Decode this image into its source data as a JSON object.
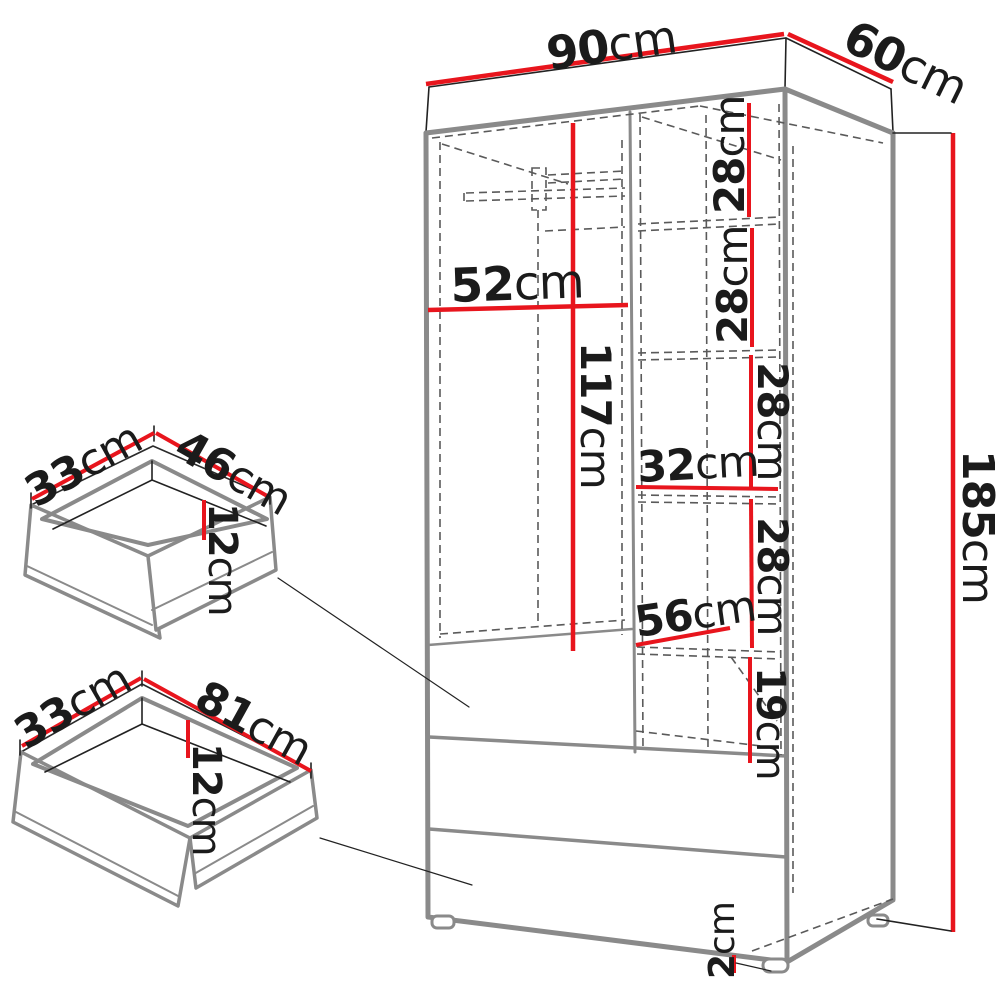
{
  "title": "Wardrobe dimension diagram",
  "unit": "cm",
  "colors": {
    "dimension_red": "#e8151d",
    "outline_gray": "#8a8a8a",
    "line_black": "#222222",
    "dashed_gray": "#5a5a5a",
    "background": "#ffffff"
  },
  "wardrobe": {
    "width": {
      "value": "90",
      "unit": "cm"
    },
    "depth": {
      "value": "60",
      "unit": "cm"
    },
    "height": {
      "value": "185",
      "unit": "cm"
    },
    "hanging_section_width": {
      "value": "52",
      "unit": "cm"
    },
    "hanging_section_height": {
      "value": "117",
      "unit": "cm"
    },
    "shelf_gaps": [
      {
        "value": "28",
        "unit": "cm"
      },
      {
        "value": "28",
        "unit": "cm"
      },
      {
        "value": "28",
        "unit": "cm"
      },
      {
        "value": "28",
        "unit": "cm"
      }
    ],
    "shelf_section_width": {
      "value": "32",
      "unit": "cm"
    },
    "shelf_depth": {
      "value": "56",
      "unit": "cm"
    },
    "bottom_niche_height": {
      "value": "19",
      "unit": "cm"
    },
    "feet_height": {
      "value": "2",
      "unit": "cm"
    }
  },
  "small_drawer": {
    "depth": {
      "value": "33",
      "unit": "cm"
    },
    "width": {
      "value": "46",
      "unit": "cm"
    },
    "inner_height": {
      "value": "12",
      "unit": "cm"
    }
  },
  "large_drawer": {
    "depth": {
      "value": "33",
      "unit": "cm"
    },
    "width": {
      "value": "81",
      "unit": "cm"
    },
    "inner_height": {
      "value": "12",
      "unit": "cm"
    }
  }
}
